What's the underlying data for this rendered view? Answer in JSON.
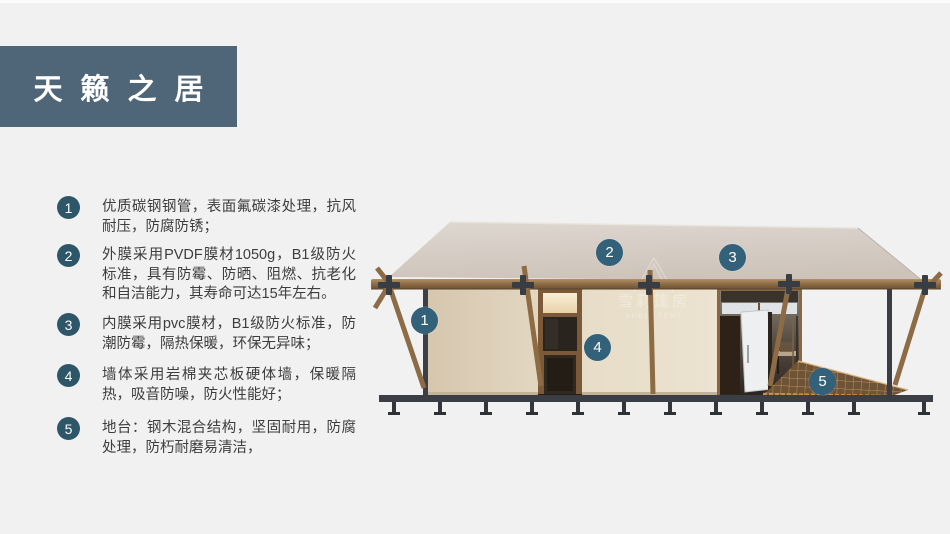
{
  "title": {
    "label": "天籁之居"
  },
  "features": [
    {
      "num": "1",
      "text": "优质碳钢钢管，表面氟碳漆处理，抗风耐压，防腐防锈；"
    },
    {
      "num": "2",
      "text": "外膜采用PVDF膜材1050g，B1级防火标准，具有防霉、防晒、阻燃、抗老化和自洁能力，其寿命可达15年左右。"
    },
    {
      "num": "3",
      "text": "内膜采用pvc膜材，B1级防火标准，防潮防霉，隔热保暖，环保无异味；"
    },
    {
      "num": "4",
      "text": "墙体采用岩棉夹芯板硬体墙，保暖隔热，吸音防噪，防火性能好；"
    },
    {
      "num": "5",
      "text": "地台：钢木混合结构，坚固耐用，防腐处理，防朽耐磨易清洁，"
    }
  ],
  "callouts": [
    {
      "num": "1"
    },
    {
      "num": "2"
    },
    {
      "num": "3"
    },
    {
      "num": "4"
    },
    {
      "num": "5"
    }
  ],
  "watermark": {
    "cn": "雪莉篷房",
    "en": "XUELI TENT"
  },
  "colors": {
    "background": "#f1f1f2",
    "banner": "#4f6678",
    "badge": "#2e5669",
    "callout": "#33617a",
    "roof": "#d5ccc4",
    "wall": "#e3d6bf",
    "wood": "#8d6b45",
    "frame_dark": "#3a3f46"
  }
}
